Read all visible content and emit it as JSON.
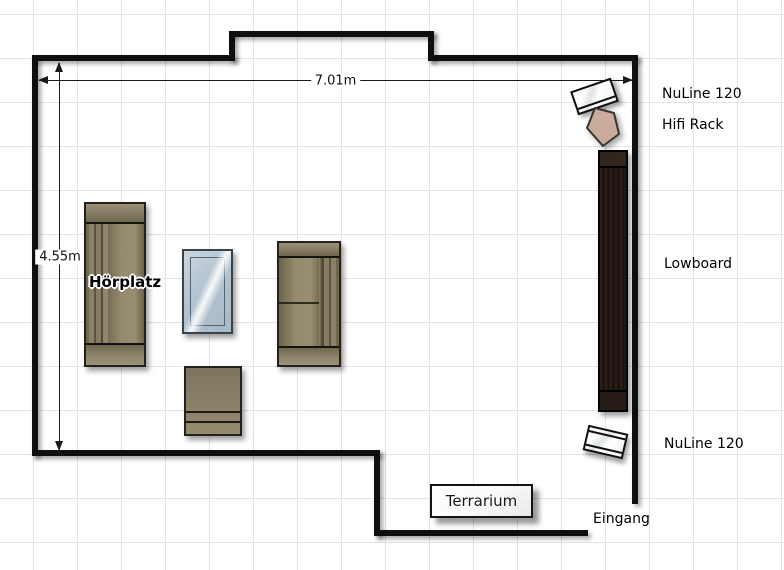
{
  "diagram": {
    "type": "floor-plan",
    "room": {
      "width_label": "7.01m",
      "height_label": "4.55m"
    }
  },
  "labels": {
    "nuline_top": "NuLine 120",
    "hifi_rack": "Hifi Rack",
    "lowboard": "Lowboard",
    "nuline_bottom": "NuLine 120",
    "entrance": "Eingang",
    "listening_position": "Hörplatz",
    "terrarium": "Terrarium"
  },
  "colors": {
    "wall": "#0f0f0f",
    "grid_line": "#e3e3e3",
    "sofa": "#8a8068",
    "lowboard": "#1d1410",
    "glass_table": "#b3c3d1",
    "hifi_rack": "#c9ac9b",
    "speaker": "#ffffff"
  }
}
